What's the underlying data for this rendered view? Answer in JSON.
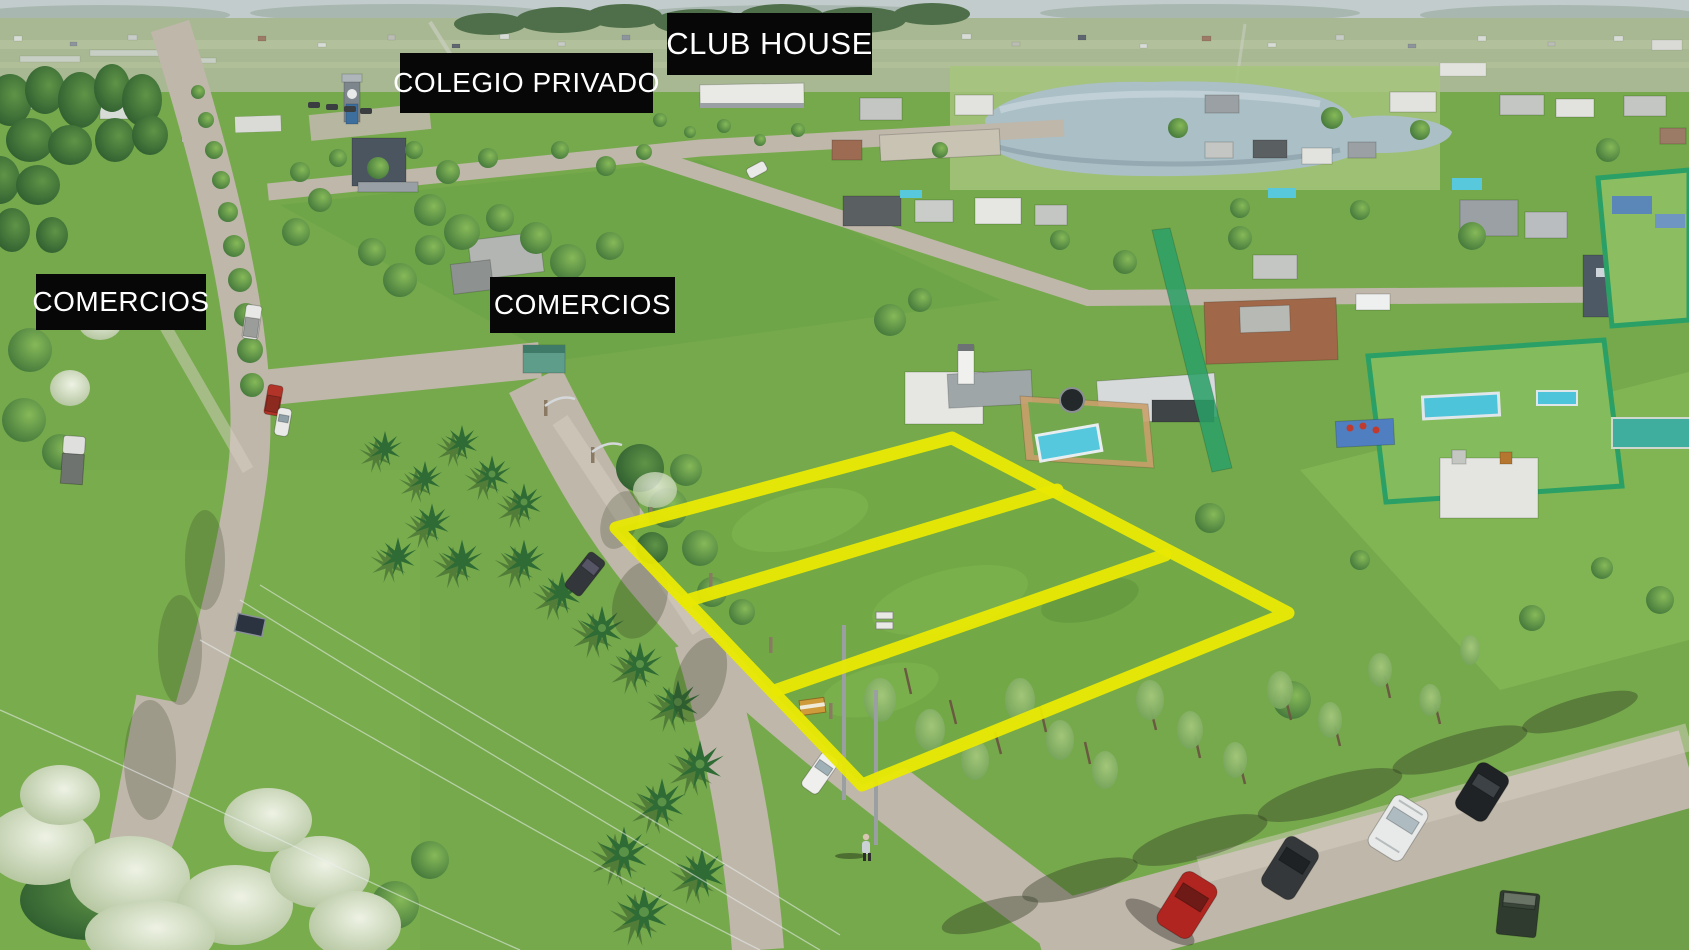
{
  "scene": {
    "description": "Aerial drone photograph of a suburban development with three vacant lots outlined in yellow",
    "colors": {
      "grass": "#76a94c",
      "road": "#bfb7aa",
      "water": "#aabfc6",
      "lot_outline": "#e9e903",
      "label_background": "#070707",
      "label_text": "#ffffff"
    }
  },
  "labels": {
    "club_house": {
      "text": "CLUB HOUSE",
      "x": 667,
      "y": 13,
      "w": 205,
      "h": 62,
      "font_px": 31
    },
    "colegio_privado": {
      "text": "COLEGIO PRIVADO",
      "x": 400,
      "y": 53,
      "w": 253,
      "h": 60,
      "font_px": 28
    },
    "comercios_left": {
      "text": "COMERCIOS",
      "x": 36,
      "y": 274,
      "w": 170,
      "h": 56,
      "font_px": 28
    },
    "comercios_center": {
      "text": "COMERCIOS",
      "x": 490,
      "y": 277,
      "w": 185,
      "h": 56,
      "font_px": 28
    }
  },
  "lot_overlay": {
    "color": "#e9e903",
    "stroke_width": 13,
    "opacity": 0.95,
    "lot_count": 3,
    "outer": [
      [
        616,
        528
      ],
      [
        952,
        438
      ],
      [
        1288,
        613
      ],
      [
        862,
        785
      ]
    ],
    "dividers": [
      [
        [
          1057,
          490
        ],
        [
          686,
          601
        ]
      ],
      [
        [
          1165,
          555
        ],
        [
          777,
          690
        ]
      ]
    ]
  }
}
